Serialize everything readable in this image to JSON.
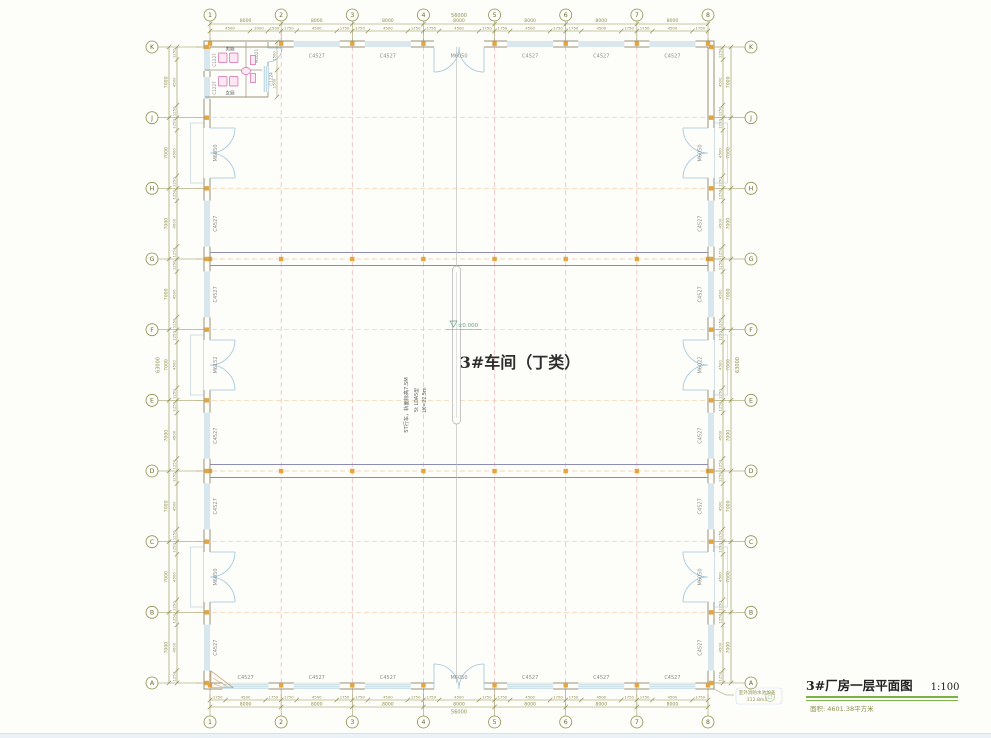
{
  "title_block": {
    "title": "3#厂房一层平面图",
    "scale": "1:100",
    "subtitle": "面积: 4601.38平方米"
  },
  "drawing": {
    "room_label": "3#车间（丁类）",
    "elevation_marker": "±0.000",
    "crane_notes": [
      "5T行车，轨面标高7.5M",
      "5t LDA5型",
      "LK=22.5m"
    ],
    "fire_pool_notes": [
      "室外消防水池加盖",
      "112.8m3"
    ],
    "grid": {
      "columns": [
        "1",
        "2",
        "3",
        "4",
        "5",
        "6",
        "7",
        "8"
      ],
      "rows": [
        "K",
        "J",
        "H",
        "G",
        "F",
        "E",
        "D",
        "C",
        "B",
        "A"
      ]
    },
    "walls": {
      "top": [
        "C4527",
        "C4527",
        "M6050",
        "C4527",
        "C4527",
        "C4527"
      ],
      "bottom": [
        "C4527",
        "C4527",
        "C4527",
        "M6050",
        "C4527",
        "C4527",
        "C4527"
      ],
      "left": [
        "M6050",
        "C4527",
        "C4527",
        "M6152",
        "C4527",
        "C4527",
        "M6050",
        "C4527"
      ],
      "right": [
        "M6050",
        "C4527",
        "C4527",
        "M6022",
        "C4527",
        "C4527",
        "M6050",
        "C4527"
      ]
    },
    "restroom": {
      "rooms": [
        "男厕",
        "女厕"
      ],
      "exterior_windows": [
        "C1227",
        "C1227"
      ],
      "side_window": "C1224",
      "door": "M1021",
      "dims": [
        "1500",
        "1500"
      ]
    },
    "dimensions": {
      "total_width": "56000",
      "bay_width": "8000",
      "first_bay_splits": [
        "4500",
        "2000",
        "1500"
      ],
      "bay_splits": [
        "1750",
        "4500",
        "1750"
      ],
      "total_height": "63000",
      "row_height": "7000",
      "row_splits": [
        "1250",
        "4500",
        "1250"
      ]
    }
  },
  "colors": {
    "grid_vertical": "#eab6b6",
    "grid_horizontal": "#edcaa4",
    "dimension": "#8f8f4f",
    "wall": "#9a9478",
    "window": "#9ec6da",
    "door_stoop": "#b8cdd8",
    "crane_beam": "#8c8cb4",
    "column_marker": "#e2a53f",
    "label_text": "#8c8c8c",
    "title_underline": "#7cb347",
    "fixture_pink": "#d06aa8",
    "fixture_fill": "#fbe8f3",
    "elevation_green": "#6aa08a",
    "channel_gray": "#b8b8b8",
    "apron_orange": "#c89050",
    "bg": "#fdfdfa"
  }
}
